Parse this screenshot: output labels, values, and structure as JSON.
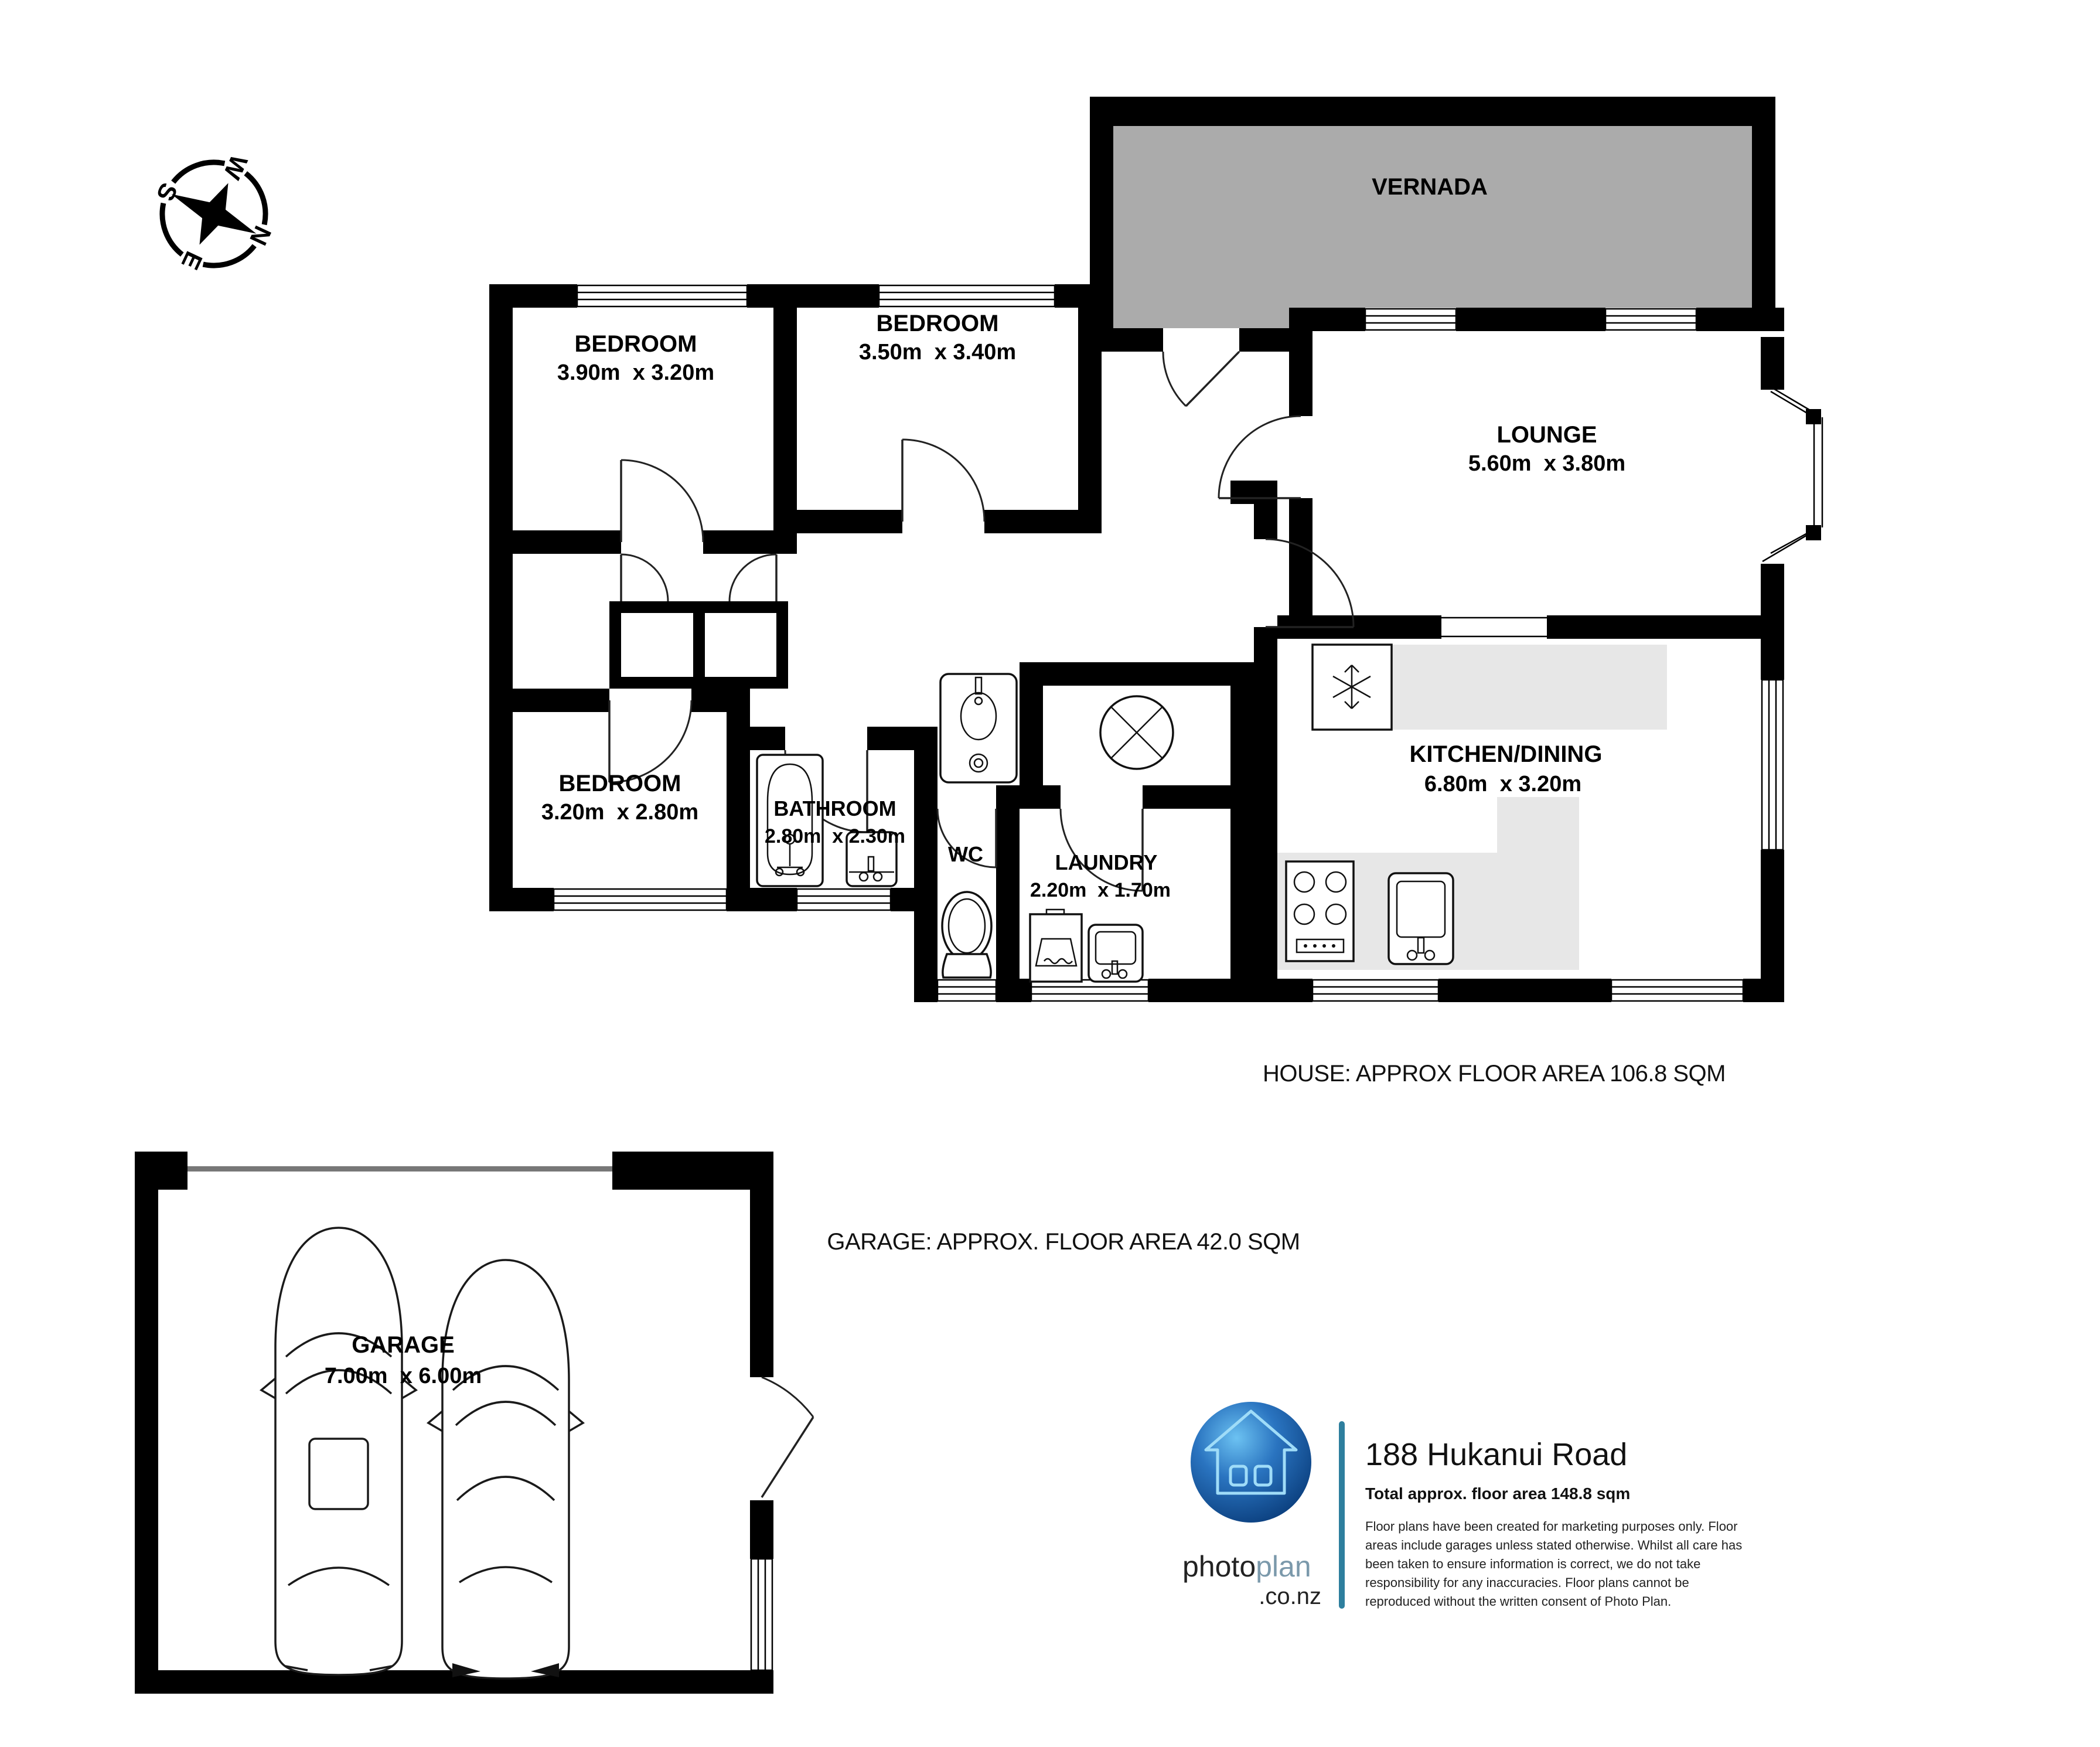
{
  "compass": {
    "n": "N",
    "e": "E",
    "s": "S",
    "w": "W"
  },
  "rooms": {
    "vernada": {
      "name": "VERNADA"
    },
    "bedroom1": {
      "name": "BEDROOM",
      "dims": "3.90m  x 3.20m"
    },
    "bedroom2": {
      "name": "BEDROOM",
      "dims": "3.50m  x 3.40m"
    },
    "bedroom3": {
      "name": "BEDROOM",
      "dims": "3.20m  x 2.80m"
    },
    "lounge": {
      "name": "LOUNGE",
      "dims": "5.60m  x 3.80m"
    },
    "kitchen": {
      "name": "KITCHEN/DINING",
      "dims": "6.80m  x 3.20m"
    },
    "bathroom": {
      "name": "BATHROOM",
      "dims": "2.80m  x 2.30m"
    },
    "wc": {
      "name": "WC"
    },
    "laundry": {
      "name": "LAUNDRY",
      "dims": "2.20m  x 1.70m"
    },
    "garage": {
      "name": "GARAGE",
      "dims": "7.00m  x 6.00m"
    }
  },
  "areas": {
    "house": "HOUSE: APPROX FLOOR AREA 106.8 SQM",
    "garage": "GARAGE: APPROX. FLOOR AREA 42.0 SQM"
  },
  "footer": {
    "brand_photo": "photo",
    "brand_plan": "plan",
    "brand_domain": ".co.nz",
    "address": "188 Hukanui Road",
    "total_area": "Total approx. floor area 148.8 sqm",
    "disclaimer_lines": [
      "Floor plans have been created for marketing purposes only. Floor",
      "areas include garages unless stated otherwise. Whilst all care has",
      "been taken to ensure information is correct, we do not take",
      "responsibility for any inaccuracies. Floor plans cannot be",
      "reproduced without the written consent of Photo Plan."
    ]
  },
  "colors": {
    "wall": "#000000",
    "verandah_fill": "#ababab",
    "counter_fill": "#e7e7e7",
    "garage_door": "#777777",
    "brand_teal": "#2e7f9e",
    "logo_sphere_light": "#58b7ee",
    "logo_sphere_dark": "#0b3f7e",
    "logo_house_outline": "#9fdcf8"
  }
}
